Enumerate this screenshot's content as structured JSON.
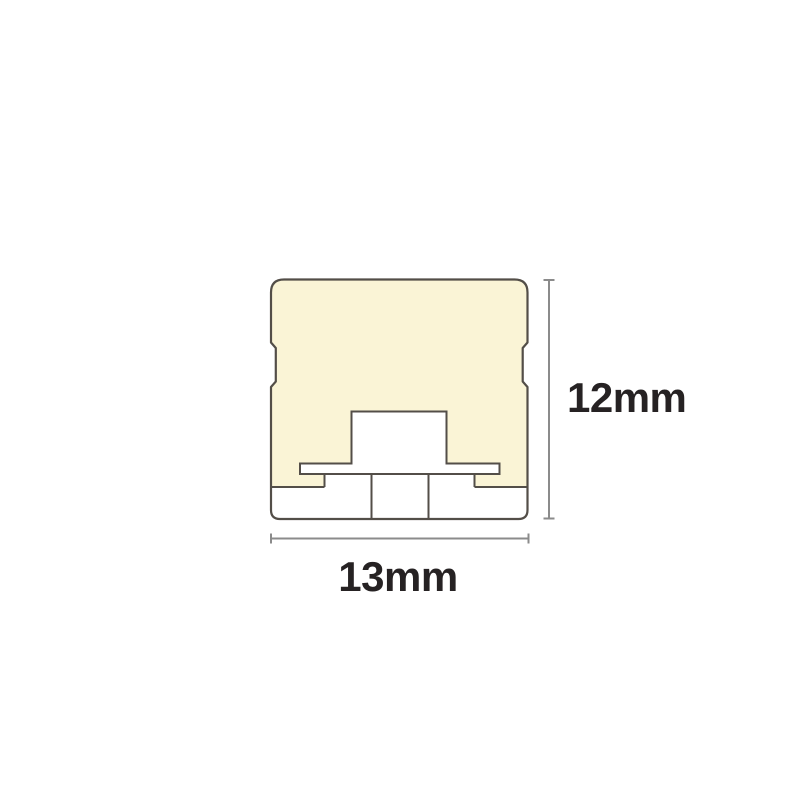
{
  "diagram": {
    "height_dimension": {
      "label": "12mm"
    },
    "width_dimension": {
      "label": "13mm"
    },
    "colors": {
      "body_fill": "#FAF4D6",
      "outline": "#534E48",
      "inner_fill": "#FFFFFF",
      "dimension_line": "#8B8B8B",
      "label_text": "#262223",
      "background": "#FFFFFF"
    }
  }
}
